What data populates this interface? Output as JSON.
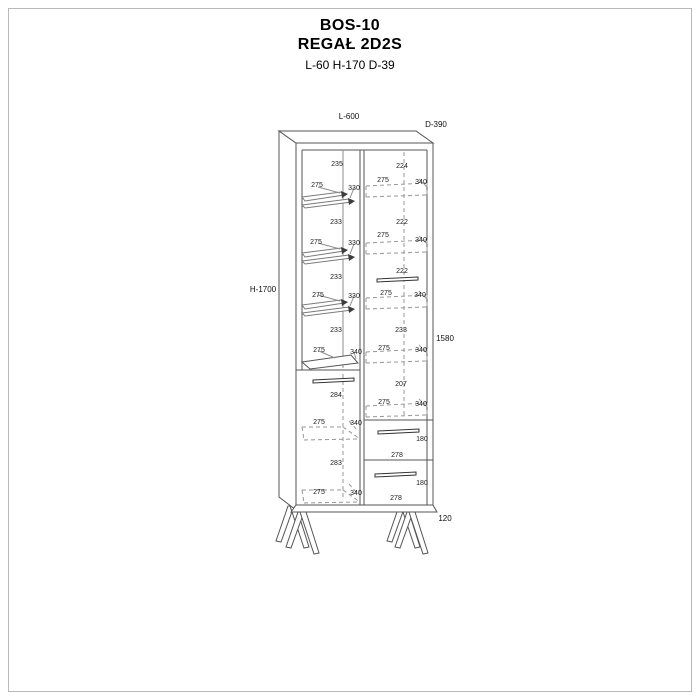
{
  "header": {
    "model": "BOS-10",
    "name": "REGAŁ 2D2S",
    "dims": "L-60 H-170 D-39"
  },
  "drawing": {
    "overall_labels": [
      {
        "name": "overall-length",
        "text": "L-600",
        "x": 349,
        "y": 119
      },
      {
        "name": "overall-depth",
        "text": "D-390",
        "x": 436,
        "y": 127
      },
      {
        "name": "overall-height",
        "text": "H-1700",
        "x": 263,
        "y": 292
      },
      {
        "name": "body-height",
        "text": "1580",
        "x": 445,
        "y": 341
      },
      {
        "name": "leg-height",
        "text": "120",
        "x": 445,
        "y": 521
      }
    ],
    "dim_labels": [
      {
        "text": "235",
        "x": 337,
        "y": 166
      },
      {
        "text": "275",
        "x": 317,
        "y": 187
      },
      {
        "text": "330",
        "x": 354,
        "y": 190
      },
      {
        "text": "233",
        "x": 336,
        "y": 224
      },
      {
        "text": "275",
        "x": 316,
        "y": 244
      },
      {
        "text": "330",
        "x": 354,
        "y": 245
      },
      {
        "text": "233",
        "x": 336,
        "y": 279
      },
      {
        "text": "275",
        "x": 318,
        "y": 297
      },
      {
        "text": "330",
        "x": 354,
        "y": 298
      },
      {
        "text": "233",
        "x": 336,
        "y": 332
      },
      {
        "text": "275",
        "x": 319,
        "y": 352
      },
      {
        "text": "340",
        "x": 356,
        "y": 354
      },
      {
        "text": "284",
        "x": 336,
        "y": 397
      },
      {
        "text": "275",
        "x": 319,
        "y": 424
      },
      {
        "text": "340",
        "x": 356,
        "y": 425
      },
      {
        "text": "283",
        "x": 336,
        "y": 465
      },
      {
        "text": "275",
        "x": 319,
        "y": 494
      },
      {
        "text": "340",
        "x": 356,
        "y": 495
      },
      {
        "text": "224",
        "x": 402,
        "y": 168
      },
      {
        "text": "275",
        "x": 383,
        "y": 182
      },
      {
        "text": "340",
        "x": 421,
        "y": 184
      },
      {
        "text": "222",
        "x": 402,
        "y": 224
      },
      {
        "text": "275",
        "x": 383,
        "y": 237
      },
      {
        "text": "340",
        "x": 421,
        "y": 242
      },
      {
        "text": "222",
        "x": 402,
        "y": 273
      },
      {
        "text": "275",
        "x": 386,
        "y": 295
      },
      {
        "text": "340",
        "x": 420,
        "y": 297
      },
      {
        "text": "233",
        "x": 401,
        "y": 332
      },
      {
        "text": "275",
        "x": 384,
        "y": 350
      },
      {
        "text": "340",
        "x": 421,
        "y": 352
      },
      {
        "text": "207",
        "x": 401,
        "y": 386
      },
      {
        "text": "275",
        "x": 384,
        "y": 404
      },
      {
        "text": "340",
        "x": 421,
        "y": 406
      },
      {
        "text": "180",
        "x": 422,
        "y": 441
      },
      {
        "text": "278",
        "x": 397,
        "y": 457
      },
      {
        "text": "180",
        "x": 422,
        "y": 485
      },
      {
        "text": "278",
        "x": 396,
        "y": 500
      }
    ]
  },
  "colors": {
    "line_main": "#555555",
    "line_hidden": "#979797",
    "text": "#1b1b1b",
    "background": "#ffffff"
  }
}
